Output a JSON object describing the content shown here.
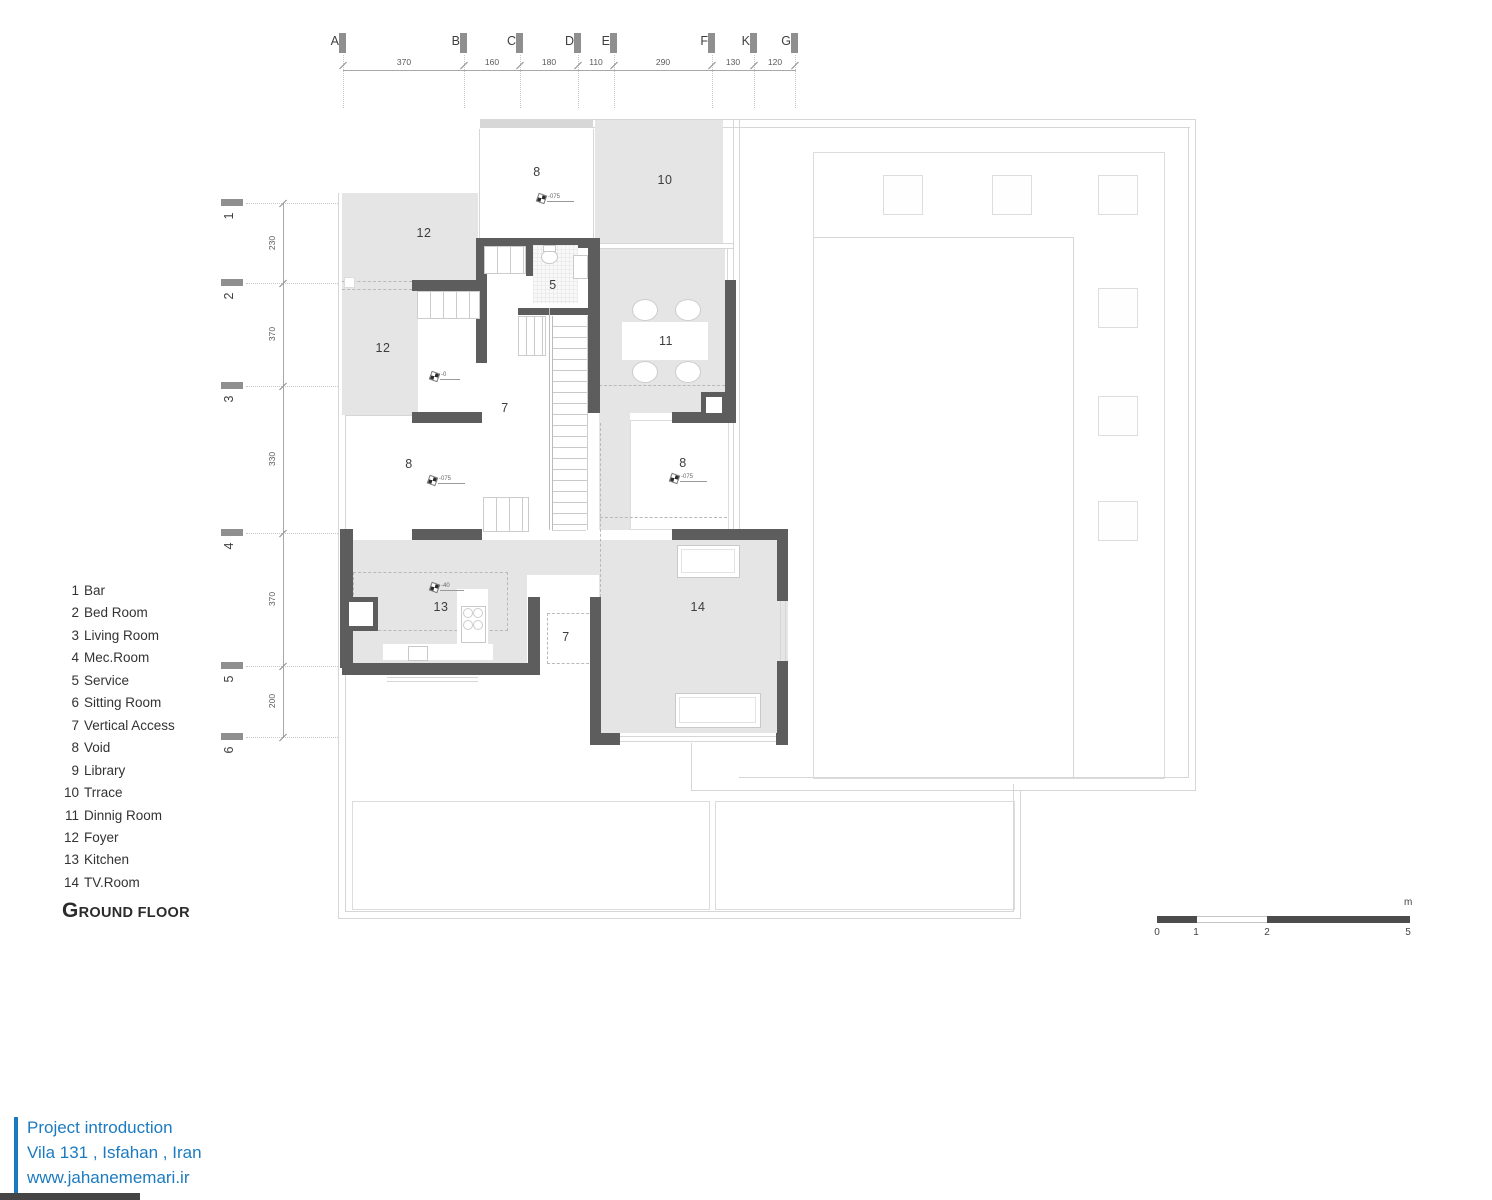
{
  "colors": {
    "wall": "#5d5d5d",
    "room_fill": "#e5e5e6",
    "accent": "#1c7bc0",
    "scale_dark": "#4c4c4c"
  },
  "title": "GROUND FLOOR",
  "legend": {
    "items": [
      {
        "num": "1",
        "label": "Bar"
      },
      {
        "num": "2",
        "label": "Bed Room"
      },
      {
        "num": "3",
        "label": "Living Room"
      },
      {
        "num": "4",
        "label": "Mec.Room"
      },
      {
        "num": "5",
        "label": "Service"
      },
      {
        "num": "6",
        "label": "Sitting Room"
      },
      {
        "num": "7",
        "label": "Vertical Access"
      },
      {
        "num": "8",
        "label": "Void"
      },
      {
        "num": "9",
        "label": "Library"
      },
      {
        "num": "10",
        "label": "Trrace"
      },
      {
        "num": "11",
        "label": "Dinnig Room"
      },
      {
        "num": "12",
        "label": "Foyer"
      },
      {
        "num": "13",
        "label": "Kitchen"
      },
      {
        "num": "14",
        "label": "TV.Room"
      }
    ]
  },
  "grid": {
    "columns": [
      {
        "label": "A",
        "x": 343
      },
      {
        "label": "B",
        "x": 464
      },
      {
        "label": "C",
        "x": 520
      },
      {
        "label": "D",
        "x": 578
      },
      {
        "label": "E",
        "x": 614
      },
      {
        "label": "F",
        "x": 712
      },
      {
        "label": "K",
        "x": 754
      },
      {
        "label": "G",
        "x": 795
      }
    ],
    "col_dims": [
      {
        "text": "370",
        "x": 404
      },
      {
        "text": "160",
        "x": 492
      },
      {
        "text": "180",
        "x": 549
      },
      {
        "text": "110",
        "x": 596
      },
      {
        "text": "290",
        "x": 663
      },
      {
        "text": "130",
        "x": 733
      },
      {
        "text": "120",
        "x": 775
      }
    ],
    "rows": [
      {
        "label": "1",
        "y": 203
      },
      {
        "label": "2",
        "y": 283
      },
      {
        "label": "3",
        "y": 386
      },
      {
        "label": "4",
        "y": 533
      },
      {
        "label": "5",
        "y": 666
      },
      {
        "label": "6",
        "y": 737
      }
    ],
    "row_dims": [
      {
        "text": "230",
        "y": 243
      },
      {
        "text": "370",
        "y": 334
      },
      {
        "text": "330",
        "y": 459
      },
      {
        "text": "370",
        "y": 599
      },
      {
        "text": "200",
        "y": 701
      }
    ]
  },
  "plan": {
    "room_labels": [
      {
        "text": "8",
        "x": 537,
        "y": 172
      },
      {
        "text": "10",
        "x": 665,
        "y": 180
      },
      {
        "text": "12",
        "x": 424,
        "y": 233
      },
      {
        "text": "5",
        "x": 553,
        "y": 285
      },
      {
        "text": "12",
        "x": 383,
        "y": 348
      },
      {
        "text": "11",
        "x": 666,
        "y": 341
      },
      {
        "text": "7",
        "x": 505,
        "y": 408
      },
      {
        "text": "8",
        "x": 409,
        "y": 464
      },
      {
        "text": "8",
        "x": 683,
        "y": 463
      },
      {
        "text": "13",
        "x": 441,
        "y": 607
      },
      {
        "text": "7",
        "x": 566,
        "y": 637
      },
      {
        "text": "14",
        "x": 698,
        "y": 607
      }
    ],
    "level_markers": [
      {
        "text": "-075",
        "x": 538,
        "y": 194
      },
      {
        "text": "-0",
        "x": 431,
        "y": 372
      },
      {
        "text": "-075",
        "x": 429,
        "y": 476
      },
      {
        "text": "-075",
        "x": 671,
        "y": 474
      },
      {
        "text": "-40",
        "x": 431,
        "y": 583
      }
    ],
    "courtyard_columns": [
      {
        "x": 883,
        "y": 175
      },
      {
        "x": 992,
        "y": 175
      },
      {
        "x": 1098,
        "y": 175
      },
      {
        "x": 1098,
        "y": 288
      },
      {
        "x": 1098,
        "y": 396
      },
      {
        "x": 1098,
        "y": 501
      }
    ]
  },
  "scalebar": {
    "unit": "m",
    "labels": [
      {
        "text": "0",
        "x": 1157
      },
      {
        "text": "1",
        "x": 1196
      },
      {
        "text": "2",
        "x": 1267
      },
      {
        "text": "5",
        "x": 1408
      }
    ]
  },
  "footer": {
    "lines": [
      "Project introduction",
      "Vila 131 , Isfahan , Iran",
      "www.jahanememari.ir"
    ]
  }
}
